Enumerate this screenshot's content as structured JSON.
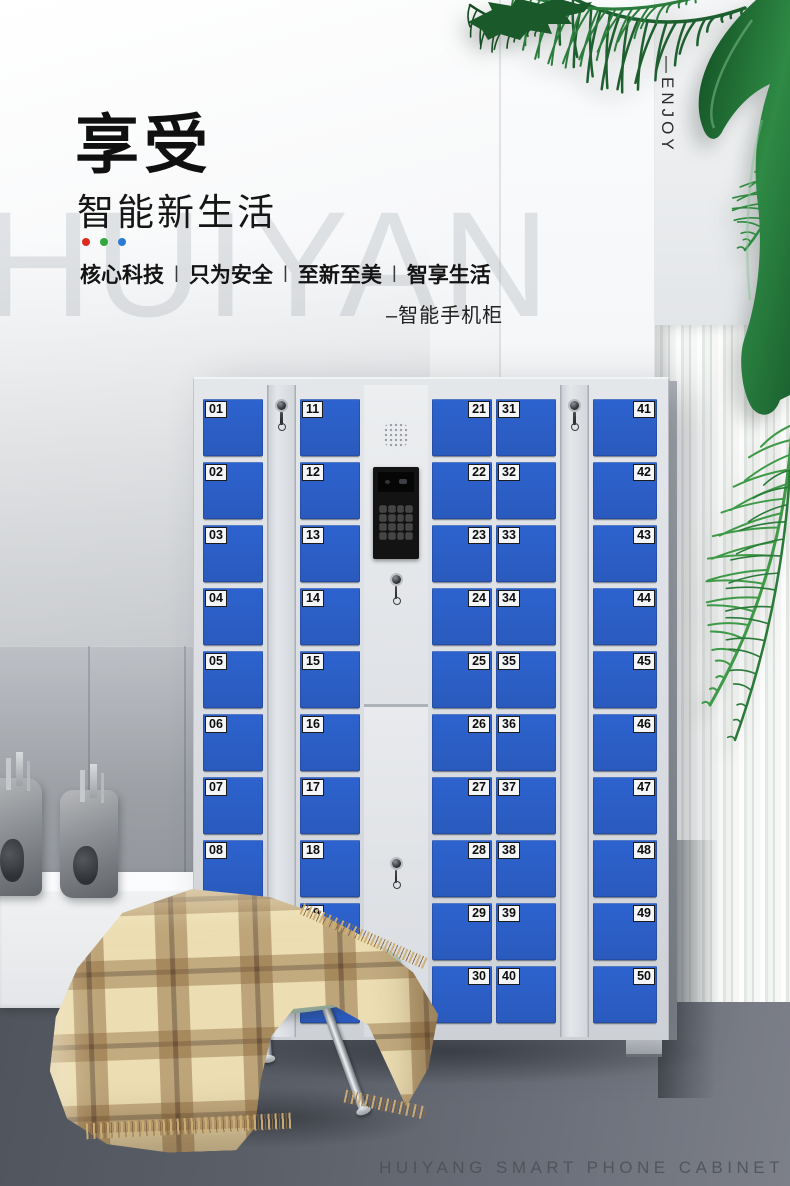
{
  "colors": {
    "door_blue": "#2d63cf",
    "dot_red": "#dd2a1e",
    "dot_green": "#2fa63e",
    "dot_blue": "#2b7bd4"
  },
  "header": {
    "title": "享受",
    "subtitle": "智能新生活",
    "tagline": [
      "核心科技",
      "只为安全",
      "至新至美",
      "智享生活"
    ],
    "tagline_separator": "|",
    "product_note": "–智能手机柜",
    "enjoy_vertical": "—ENJOY"
  },
  "watermark": "HUIYAN",
  "footer": "HUIYANG SMART PHONE CABINET",
  "cabinet": {
    "columns": [
      {
        "type": "doors",
        "label_side": "left",
        "numbers": [
          "01",
          "02",
          "03",
          "04",
          "05",
          "06",
          "07",
          "08",
          "09",
          "10"
        ]
      },
      {
        "type": "lock"
      },
      {
        "type": "doors",
        "label_side": "left",
        "numbers": [
          "11",
          "12",
          "13",
          "14",
          "15",
          "16",
          "17",
          "18",
          "19",
          "20"
        ]
      },
      {
        "type": "control"
      },
      {
        "type": "doors",
        "label_side": "right",
        "numbers": [
          "21",
          "22",
          "23",
          "24",
          "25",
          "26",
          "27",
          "28",
          "29",
          "30"
        ]
      },
      {
        "type": "doors",
        "label_side": "left",
        "numbers": [
          "31",
          "32",
          "33",
          "34",
          "35",
          "36",
          "37",
          "38",
          "39",
          "40"
        ]
      },
      {
        "type": "lock"
      },
      {
        "type": "doors",
        "label_side": "right",
        "numbers": [
          "41",
          "42",
          "43",
          "44",
          "45",
          "46",
          "47",
          "48",
          "49",
          "50"
        ]
      }
    ]
  }
}
